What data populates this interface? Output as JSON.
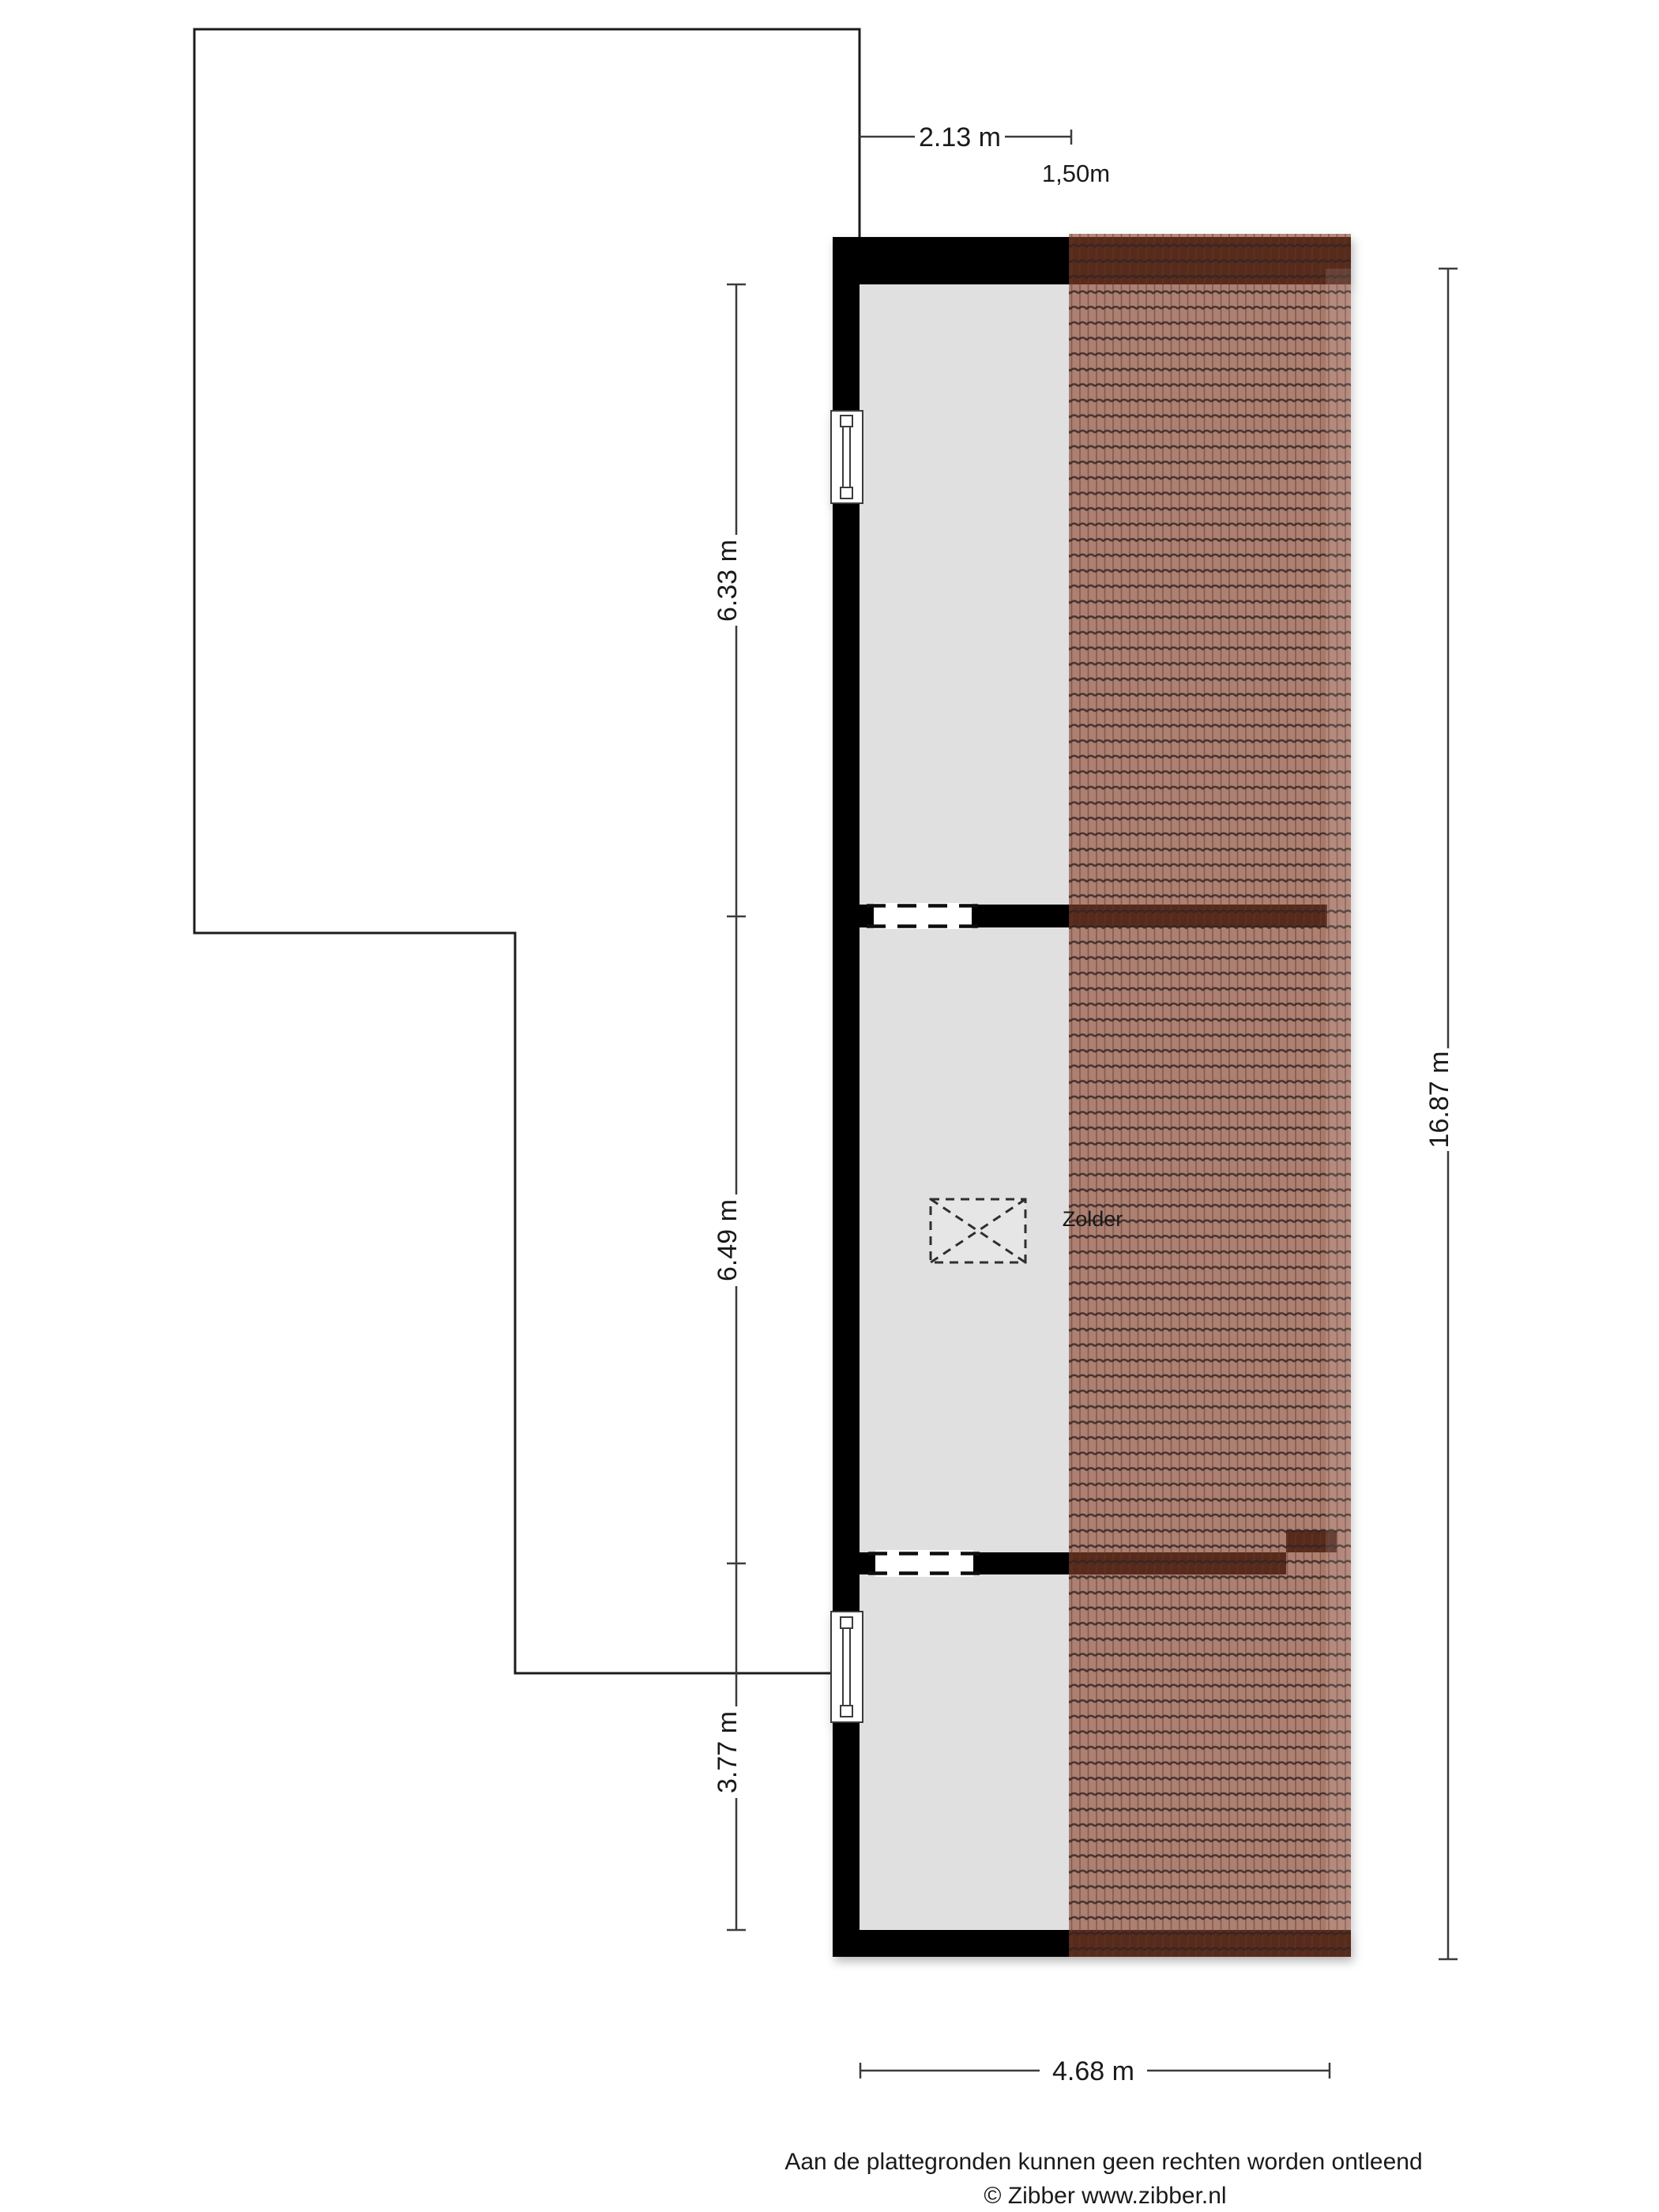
{
  "floorplan": {
    "room_label": "Zolder",
    "dimensions": {
      "top_width": "2.13 m",
      "headroom_width": "1,50m",
      "left_segment_top": "6.33 m",
      "left_segment_middle": "6.49 m",
      "left_segment_bottom": "3.77 m",
      "right_total_height": "16.87 m",
      "bottom_width": "4.68 m"
    },
    "footer": {
      "disclaimer": "Aan de plattegronden kunnen geen rechten worden ontleend",
      "copyright": "© Zibber www.zibber.nl"
    },
    "symbols": {
      "stair_opening": "dashed-rectangle-with-x",
      "window": "double-line-window",
      "roof": "tiled-roof-hatch"
    },
    "colors": {
      "background": "#ffffff",
      "wall": "#000000",
      "floor": "#e0e0e0",
      "roof_tile_base": "#8e452e",
      "roof_tile_row_line": "#2f2320",
      "roof_tile_column_line": "#5a382c",
      "outline": "#1c1c1c",
      "dimension_line": "#3c3c3c",
      "text": "#1a1a1a"
    }
  }
}
